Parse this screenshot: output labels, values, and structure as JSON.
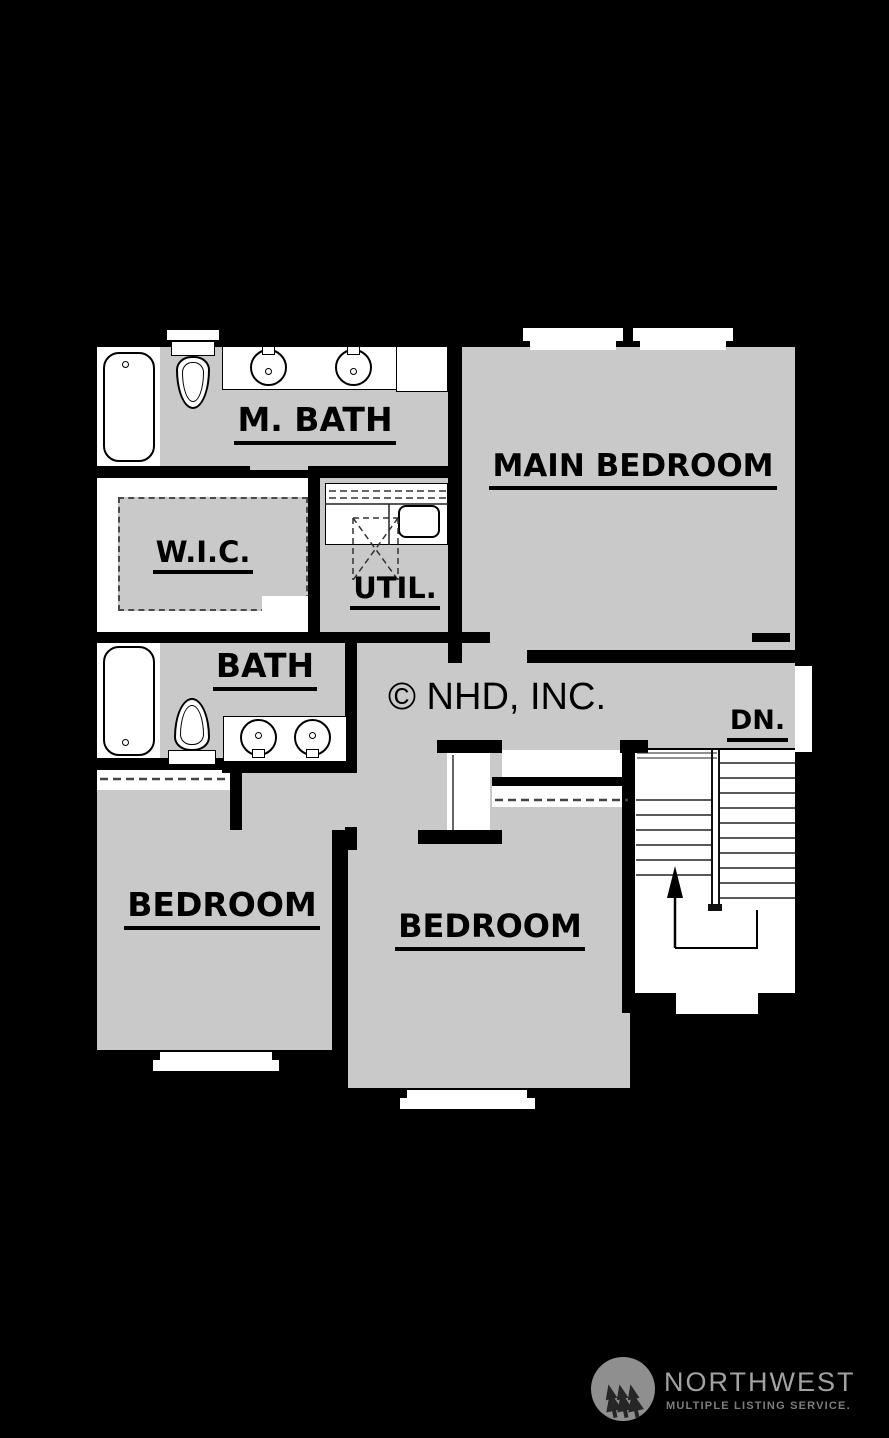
{
  "palette": {
    "bg": "#000000",
    "floor": "#c9c9c9",
    "wall": "#000000",
    "fixture": "#ffffff",
    "line": "#2a2a2a"
  },
  "rooms": {
    "m_bath": {
      "label": "M. BATH"
    },
    "main_bedroom": {
      "label": "MAIN BEDROOM"
    },
    "wic": {
      "label": "W.I.C."
    },
    "util": {
      "label": "UTIL."
    },
    "bath": {
      "label": "BATH"
    },
    "bedroom_left": {
      "label": "BEDROOM"
    },
    "bedroom_center": {
      "label": "BEDROOM"
    },
    "stair": {
      "label": "DN."
    }
  },
  "annotations": {
    "copyright": "© NHD, INC."
  },
  "fixtures": [
    "bathtub-icon",
    "toilet-icon",
    "sink-icon",
    "washer-dryer-icon",
    "staircase",
    "stair-up-arrow-icon",
    "window",
    "closet-rod-dashed"
  ],
  "logo": {
    "title": "NORTHWEST",
    "subtitle": "MULTIPLE LISTING SERVICE.",
    "icon": "three-trees-icon",
    "colors": {
      "badge": "#8f8f8f",
      "trees": "#262626",
      "title": "#a2a2a2",
      "subtitle": "#7d7d7d"
    }
  }
}
